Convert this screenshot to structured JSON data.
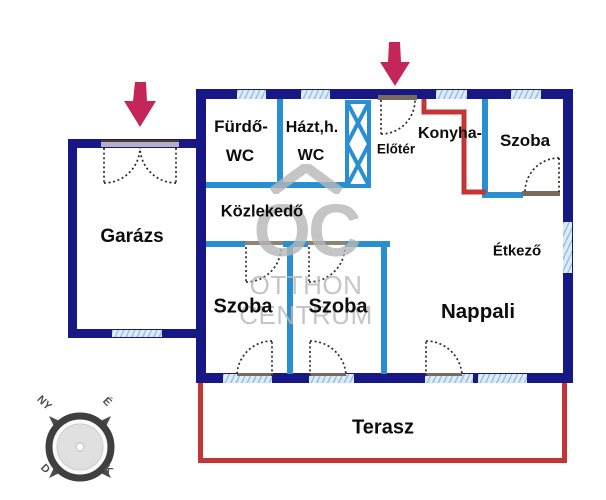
{
  "plan": {
    "rooms": {
      "furdo_line1": "Fürdő-",
      "furdo_line2": "WC",
      "hazt_line1": "Házt,h.",
      "hazt_line2": "WC",
      "eloter": "Előtér",
      "konyha": "Konyha-",
      "szoba_top_right": "Szoba",
      "kozlekedo": "Közlekedő",
      "garazs": "Garázs",
      "szoba_left": "Szoba",
      "szoba_middle": "Szoba",
      "etkezo": "Étkező",
      "nappali": "Nappali",
      "terasz": "Terasz"
    }
  },
  "watermark": {
    "logo": "OC",
    "line1": "OTTHON",
    "line2": "CENTRUM"
  },
  "compass": {
    "nw": "NY",
    "ne": "É",
    "sw": "D",
    "se": "K"
  },
  "colors": {
    "outer_wall": "#171785",
    "partition_wall": "#2a8fd2",
    "window_fill": "#dcebf6",
    "kitchen_terrace_line": "#c23636",
    "entrance_arrow": "#c5265a",
    "watermark_gray": "#b7b7b7"
  }
}
